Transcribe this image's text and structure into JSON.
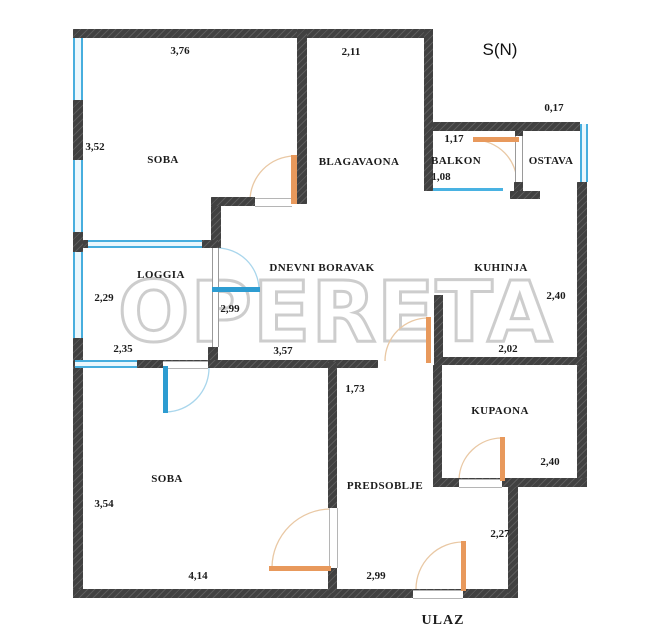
{
  "plan_title": "apartment floor plan",
  "compass": "S(N)",
  "watermark": "OPERETA",
  "rooms": {
    "soba_top": "SOBA",
    "blagavaona": "BLAGAVAONA",
    "balkon": "BALKON",
    "ostava": "OSTAVA",
    "loggia": "LOGGIA",
    "dnevni_boravak": "DNEVNI BORAVAK",
    "kuhinja": "KUHINJA",
    "kupaona": "KUPAONA",
    "predsoblje": "PREDSOBLJE",
    "soba_bottom": "SOBA",
    "ulaz": "ULAZ"
  },
  "dims": {
    "soba_top_width": "3,76",
    "blagavaona_width": "2,11",
    "ostava_offset": "0,17",
    "soba_top_height": "3,52",
    "balkon_door_width": "1,17",
    "balkon_window_width": "1,08",
    "loggia_height": "2,29",
    "loggia_glazing": "2,99",
    "kuhinja_height": "2,40",
    "loggia_width": "2,35",
    "dnevni_width": "3,57",
    "kuhinja_width": "2,02",
    "hall_top_width": "1,73",
    "kupaona_height": "2,40",
    "soba_bottom_height": "3,54",
    "step_height": "2,27",
    "soba_bottom_width": "4,14",
    "predsoblje_width": "2,99"
  },
  "colors": {
    "wall": "#414141",
    "window_blue": "#47aede",
    "door_orange": "#e8995c",
    "balcony_door_blue": "#2d9cd1",
    "arc_orange": "#e9c8a4",
    "arc_blue": "#a9d6ec",
    "watermark_gray": "#b0b0b0"
  }
}
